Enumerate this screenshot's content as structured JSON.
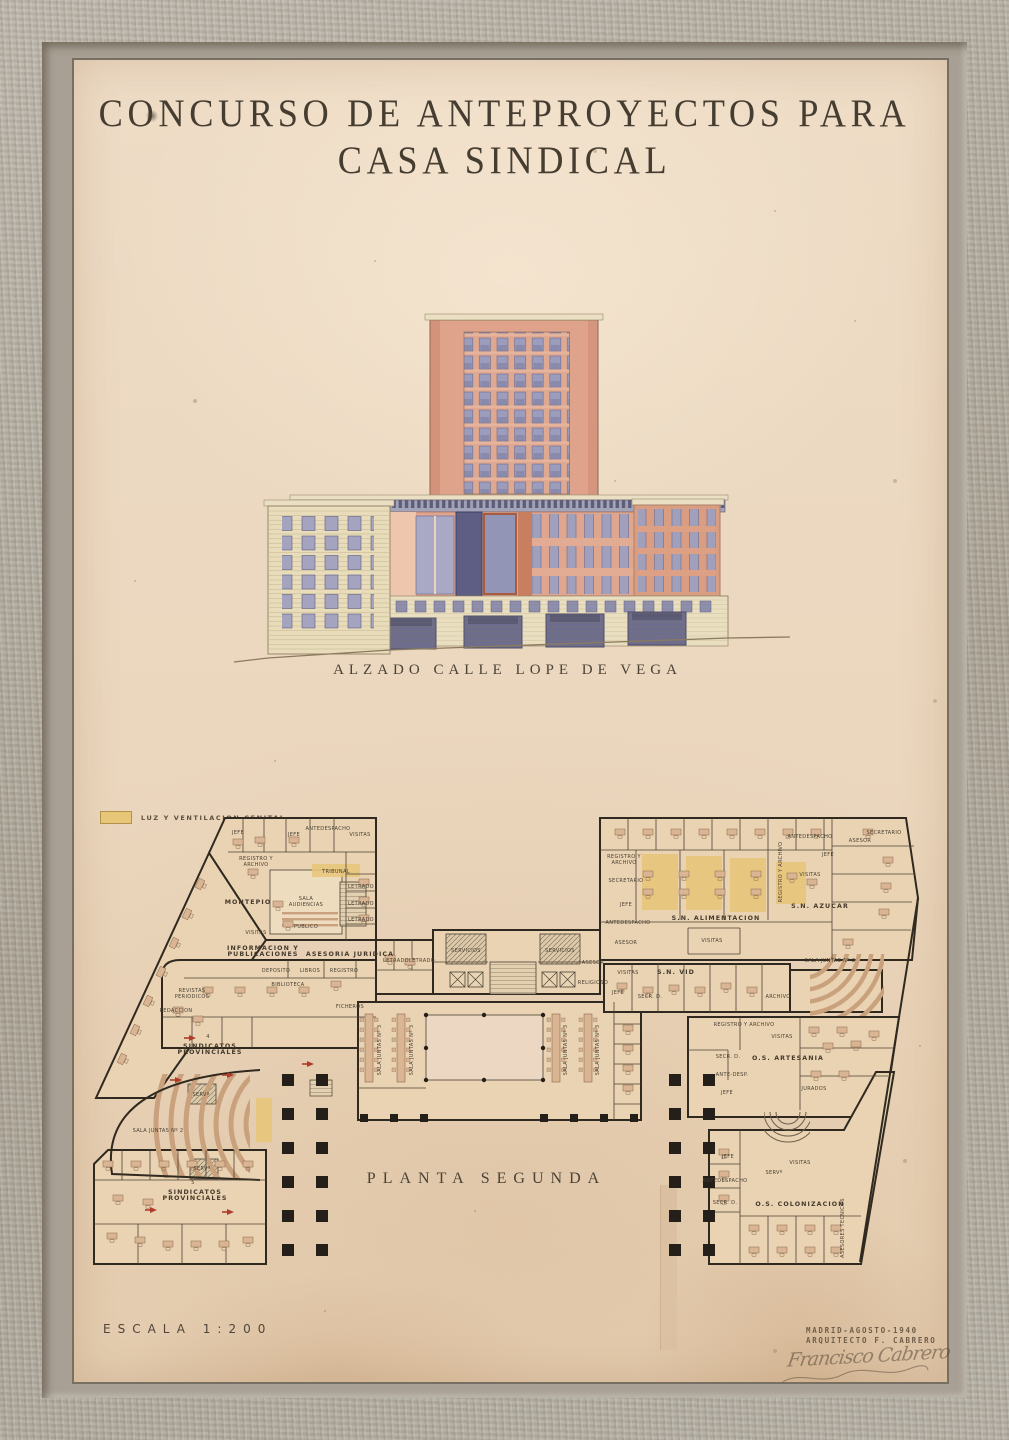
{
  "artwork": {
    "title_line1": "CONCURSO DE ANTEPROYECTOS PARA",
    "title_line2": "CASA SINDICAL",
    "elevation": {
      "caption": "ALZADO CALLE LOPE DE VEGA"
    },
    "plan_caption": "PLANTA SEGUNDA",
    "legend": {
      "label": "LUZ Y VENTILACION CENITAL",
      "swatch_color": "#e7c678"
    },
    "scale_label": "ESCALA 1:200",
    "credits": [
      "MADRID-AGOSTO-1940",
      "ARQUITECTO F. CABRERO"
    ],
    "signature": "Francisco Cabrero"
  },
  "colors": {
    "paper": "#ecd8c2",
    "frame_wood": "#b5aea3",
    "ink": "#483f33",
    "plan_wall": "#30291f",
    "tower_salmon": "#dfa28b",
    "window_lavender": "#9c9cbc",
    "facade_cream": "#e8dcba",
    "glass_dark": "#5e5e84",
    "door_blue": "#6e6e8c",
    "highlight_yellow": "#e7c678",
    "arrow_red": "#ae3d2c",
    "furniture_tan": "#d9b593"
  },
  "plan": {
    "rooms": [
      {
        "t": "JEFE",
        "x": 150,
        "y": 22
      },
      {
        "t": "JEFE",
        "x": 206,
        "y": 24
      },
      {
        "t": "ANTEDESPACHO",
        "x": 240,
        "y": 18
      },
      {
        "t": "VISITAS",
        "x": 272,
        "y": 24
      },
      {
        "t": "REGISTRO Y\nARCHIVO",
        "x": 168,
        "y": 48
      },
      {
        "t": "TRIBUNAL",
        "x": 248,
        "y": 61
      },
      {
        "t": "MONTEPIO",
        "x": 160,
        "y": 92,
        "s": 2
      },
      {
        "t": "SALA\nAUDIENCIAS",
        "x": 218,
        "y": 88
      },
      {
        "t": "PUBLICO",
        "x": 218,
        "y": 116
      },
      {
        "t": "VISITAS",
        "x": 168,
        "y": 122
      },
      {
        "t": "LETRADO",
        "x": 273,
        "y": 76
      },
      {
        "t": "LETRADO",
        "x": 273,
        "y": 93
      },
      {
        "t": "LETRADO",
        "x": 273,
        "y": 109
      },
      {
        "t": "INFORMACION Y\nPUBLICACIONES",
        "x": 175,
        "y": 138,
        "s": 2
      },
      {
        "t": "ASESORIA JURIDICA",
        "x": 262,
        "y": 144,
        "s": 2
      },
      {
        "t": "DEPOSITO",
        "x": 188,
        "y": 160
      },
      {
        "t": "LIBROS",
        "x": 222,
        "y": 160
      },
      {
        "t": "REGISTRO",
        "x": 256,
        "y": 160
      },
      {
        "t": "BIBLIOTECA",
        "x": 200,
        "y": 174
      },
      {
        "t": "REVISTAS\nPERIODICOS",
        "x": 104,
        "y": 180
      },
      {
        "t": "FICHEROS",
        "x": 262,
        "y": 196
      },
      {
        "t": "REDACCION",
        "x": 88,
        "y": 200
      },
      {
        "t": "LETRADO",
        "x": 308,
        "y": 150
      },
      {
        "t": "LETRADO",
        "x": 334,
        "y": 150
      },
      {
        "t": "SERVICIOS",
        "x": 378,
        "y": 140
      },
      {
        "t": "SERVICIOS",
        "x": 472,
        "y": 140
      },
      {
        "t": "ASESOR",
        "x": 505,
        "y": 152
      },
      {
        "t": "RELIGIOSO",
        "x": 505,
        "y": 172
      },
      {
        "t": "4",
        "x": 120,
        "y": 226
      },
      {
        "t": "SINDICATOS\nPROVINCIALES",
        "x": 122,
        "y": 236,
        "s": 2
      },
      {
        "t": "SALA JUNTAS Nº 3",
        "x": 293,
        "y": 238,
        "r": -90
      },
      {
        "t": "SALA JUNTAS Nº 3",
        "x": 325,
        "y": 238,
        "r": -90
      },
      {
        "t": "SALA JUNTAS Nº 3",
        "x": 479,
        "y": 238,
        "r": -90
      },
      {
        "t": "SALA JUNTAS Nº 3",
        "x": 511,
        "y": 238,
        "r": -90
      },
      {
        "t": "SALA JUNTAS Nº 2",
        "x": 70,
        "y": 320
      },
      {
        "t": "SERVº",
        "x": 113,
        "y": 284
      },
      {
        "t": "SERVº",
        "x": 114,
        "y": 358
      },
      {
        "t": "5",
        "x": 105,
        "y": 372
      },
      {
        "t": "SINDICATOS\nPROVINCIALES",
        "x": 107,
        "y": 382,
        "s": 2
      },
      {
        "t": "REGISTRO Y\nARCHIVO",
        "x": 536,
        "y": 46
      },
      {
        "t": "SECRETARIO",
        "x": 538,
        "y": 70
      },
      {
        "t": "JEFE",
        "x": 538,
        "y": 94
      },
      {
        "t": "ANTEDESPACHO",
        "x": 540,
        "y": 112
      },
      {
        "t": "ASESOR",
        "x": 538,
        "y": 132
      },
      {
        "t": "S.N. ALIMENTACION",
        "x": 628,
        "y": 108,
        "s": 2
      },
      {
        "t": "VISITAS",
        "x": 624,
        "y": 130
      },
      {
        "t": "REGISTRO Y ARCHIVO",
        "x": 694,
        "y": 60,
        "r": -90
      },
      {
        "t": "ANTEDESPACHO",
        "x": 722,
        "y": 26
      },
      {
        "t": "JEFE",
        "x": 740,
        "y": 44
      },
      {
        "t": "ASESOR",
        "x": 772,
        "y": 30
      },
      {
        "t": "SECRETARIO",
        "x": 796,
        "y": 22
      },
      {
        "t": "VISITAS",
        "x": 722,
        "y": 64
      },
      {
        "t": "S.N. AZUCAR",
        "x": 732,
        "y": 96,
        "s": 2
      },
      {
        "t": "SALA JUNTAS Nº 2",
        "x": 742,
        "y": 150
      },
      {
        "t": "VISITAS",
        "x": 540,
        "y": 162
      },
      {
        "t": "S.N. VID",
        "x": 588,
        "y": 162,
        "s": 2
      },
      {
        "t": "JEFE",
        "x": 530,
        "y": 182
      },
      {
        "t": "SECR. D.",
        "x": 562,
        "y": 186
      },
      {
        "t": "ARCHIVO",
        "x": 690,
        "y": 186
      },
      {
        "t": "REGISTRO Y ARCHIVO",
        "x": 656,
        "y": 214
      },
      {
        "t": "VISITAS",
        "x": 694,
        "y": 226
      },
      {
        "t": "O.S. ARTESANIA",
        "x": 700,
        "y": 248,
        "s": 2
      },
      {
        "t": "SECR. D.",
        "x": 640,
        "y": 246
      },
      {
        "t": "ANTE-DESP.",
        "x": 644,
        "y": 264
      },
      {
        "t": "JEFE",
        "x": 639,
        "y": 282
      },
      {
        "t": "JURADOS",
        "x": 726,
        "y": 278
      },
      {
        "t": "JEFE",
        "x": 640,
        "y": 346
      },
      {
        "t": "SERVº",
        "x": 686,
        "y": 362
      },
      {
        "t": "VISITAS",
        "x": 712,
        "y": 352
      },
      {
        "t": "ANTEDESPACHO",
        "x": 637,
        "y": 370
      },
      {
        "t": "SECR. D.",
        "x": 637,
        "y": 392
      },
      {
        "t": "O.S. COLONIZACION",
        "x": 712,
        "y": 394,
        "s": 2
      },
      {
        "t": "ASESORES TECNICOS",
        "x": 756,
        "y": 416,
        "r": -90
      }
    ]
  }
}
